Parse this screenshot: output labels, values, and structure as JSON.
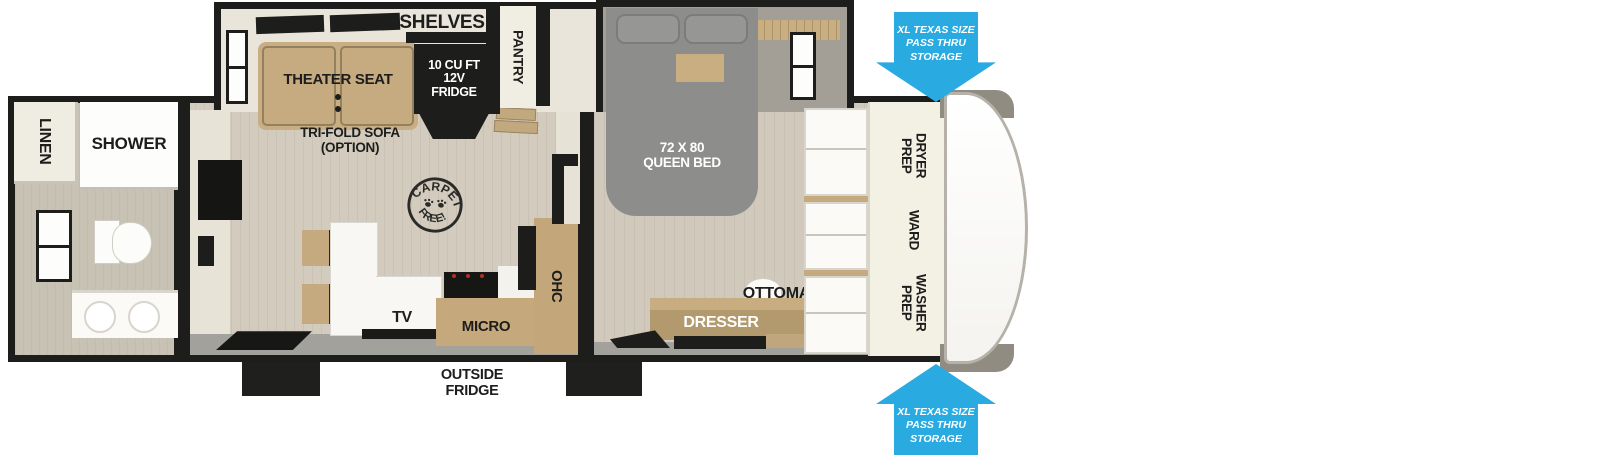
{
  "floorplan": {
    "labels": {
      "shelves": "SHELVES",
      "pantry": "PANTRY",
      "fridge": "10 CU FT\n12V\nFRIDGE",
      "theater_seat": "THEATER SEAT",
      "trifold_sofa": "TRI-FOLD SOFA\n(OPTION)",
      "linen": "LINEN",
      "shower": "SHOWER",
      "carpet_free_top": "CARPET",
      "carpet_free_bottom": "FREE!",
      "tv": "TV",
      "micro": "MICRO",
      "ohc": "OHC",
      "outside_fridge": "OUTSIDE\nFRIDGE",
      "queen_bed": "72 X 80\nQUEEN BED",
      "ottoman": "OTTOMAN",
      "dresser": "DRESSER",
      "dryer_prep": "DRYER\nPREP",
      "ward": "WARD",
      "washer_prep": "WASHER\nPREP",
      "storage_top": "XL TEXAS SIZE\nPASS THRU\nSTORAGE",
      "storage_bottom": "XL TEXAS SIZE\nPASS THRU\nSTORAGE"
    },
    "colors": {
      "arrow_blue": "#29abe2",
      "wall_black": "#1d1d1b",
      "wood_floor": "#d3ccbe",
      "furniture_tan": "#c5aa80",
      "bed_gray": "#8d8d8b",
      "counter_white": "#f8f7f4",
      "wall_cream": "#e9e5da"
    }
  }
}
